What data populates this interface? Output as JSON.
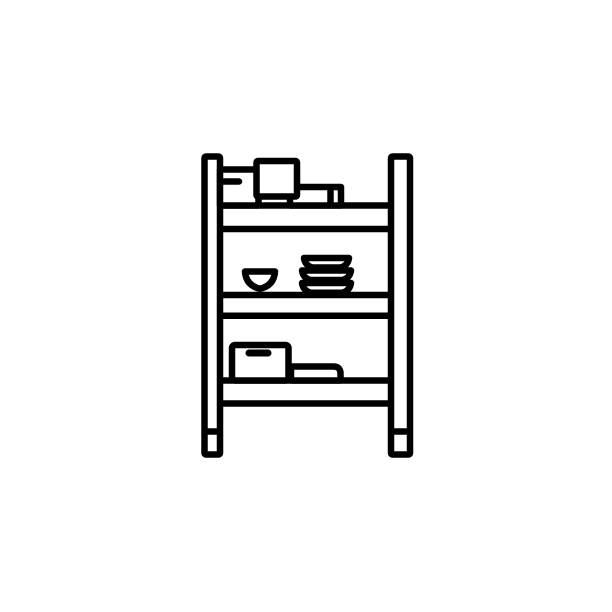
{
  "meta": {
    "description": "Black outline icon of a storage shelf rack with two posts on feet, three shelves, boxes on the top shelf, a bowl and a stack of dishes on the middle shelf, and a box with handle plus a flat tray on the bottom shelf",
    "background_color": "#ffffff",
    "stroke_color": "#000000",
    "default_stroke_width": 6.5,
    "canvas": {
      "width": 612,
      "height": 612
    }
  },
  "icon": {
    "name": "shelf-with-items-icon",
    "shapes": [
      {
        "name": "left-post",
        "type": "rect",
        "x": 204.5,
        "y": 156.5,
        "w": 15.5,
        "h": 298,
        "rx": 1.5
      },
      {
        "name": "right-post",
        "type": "rect",
        "x": 391,
        "y": 156.5,
        "w": 19,
        "h": 298,
        "rx": 1.5
      },
      {
        "name": "left-foot-divider",
        "type": "line",
        "x1": 203,
        "y1": 431.5,
        "x2": 221.5,
        "y2": 431.5
      },
      {
        "name": "right-foot-divider",
        "type": "line",
        "x1": 389.5,
        "y1": 431.5,
        "x2": 411.5,
        "y2": 431.5
      },
      {
        "name": "shelf-top-upper-edge",
        "type": "line",
        "x1": 219,
        "y1": 205.5,
        "x2": 393,
        "y2": 205.5
      },
      {
        "name": "shelf-top-lower-edge",
        "type": "line",
        "x1": 219,
        "y1": 229,
        "x2": 393,
        "y2": 229
      },
      {
        "name": "shelf-middle-upper-edge",
        "type": "line",
        "x1": 219,
        "y1": 295,
        "x2": 393,
        "y2": 295
      },
      {
        "name": "shelf-middle-lower-edge",
        "type": "line",
        "x1": 219,
        "y1": 315.75,
        "x2": 393,
        "y2": 315.75
      },
      {
        "name": "shelf-bottom-upper-edge",
        "type": "line",
        "x1": 219,
        "y1": 380.5,
        "x2": 393,
        "y2": 380.5
      },
      {
        "name": "shelf-bottom-lower-edge",
        "type": "line",
        "x1": 219,
        "y1": 403.5,
        "x2": 393,
        "y2": 403.5
      },
      {
        "name": "top-shelf-small-box",
        "type": "path",
        "d": "M220 205.5 V169.5 H258.5 V205.5 Z"
      },
      {
        "name": "top-shelf-small-box-handle",
        "type": "line",
        "x1": 221,
        "y1": 181.5,
        "x2": 239,
        "y2": 181.5,
        "cap": "round"
      },
      {
        "name": "top-shelf-flat-box",
        "type": "path",
        "d": "M290 205.5 V187 H341 V205.5 Z"
      },
      {
        "name": "top-shelf-flat-box-divider",
        "type": "line",
        "x1": 330.5,
        "y1": 189,
        "x2": 330.5,
        "y2": 203
      },
      {
        "name": "top-shelf-tall-box",
        "type": "rect",
        "x": 256.5,
        "y": 161,
        "w": 40.5,
        "h": 35.5,
        "rx": 1.5
      },
      {
        "name": "middle-shelf-bowl",
        "type": "path",
        "d": "M245 271.5 H275 Q274 285.5 260 288.75 Q246 285.5 245 271.5 Z"
      },
      {
        "name": "middle-shelf-stacked-dish-1",
        "type": "path",
        "d": "M304 258 H349 Q348 265.5 340.5 267.5 H312.5 Q305 265.5 304 258 Z"
      },
      {
        "name": "middle-shelf-stacked-dish-2",
        "type": "path",
        "d": "M302 270.5 H351 Q350 278 342.5 280 H310.5 Q303 278 302 270.5 Z"
      },
      {
        "name": "middle-shelf-stacked-dish-3",
        "type": "path",
        "d": "M302 283 H351 Q350 290.5 342.5 292.75 H310.5 Q303 290.5 302 283 Z"
      },
      {
        "name": "bottom-shelf-tray",
        "type": "path",
        "d": "M291 380.5 V366.5 H333.5 Q340.5 366.5 340.5 373.5 V380.5 Z"
      },
      {
        "name": "bottom-shelf-box",
        "type": "rect",
        "x": 232,
        "y": 345,
        "w": 56.5,
        "h": 35.5,
        "rx": 3
      },
      {
        "name": "bottom-shelf-box-handle",
        "type": "line",
        "x1": 249,
        "y1": 353,
        "x2": 268,
        "y2": 353,
        "sw": 7,
        "cap": "round"
      }
    ]
  }
}
